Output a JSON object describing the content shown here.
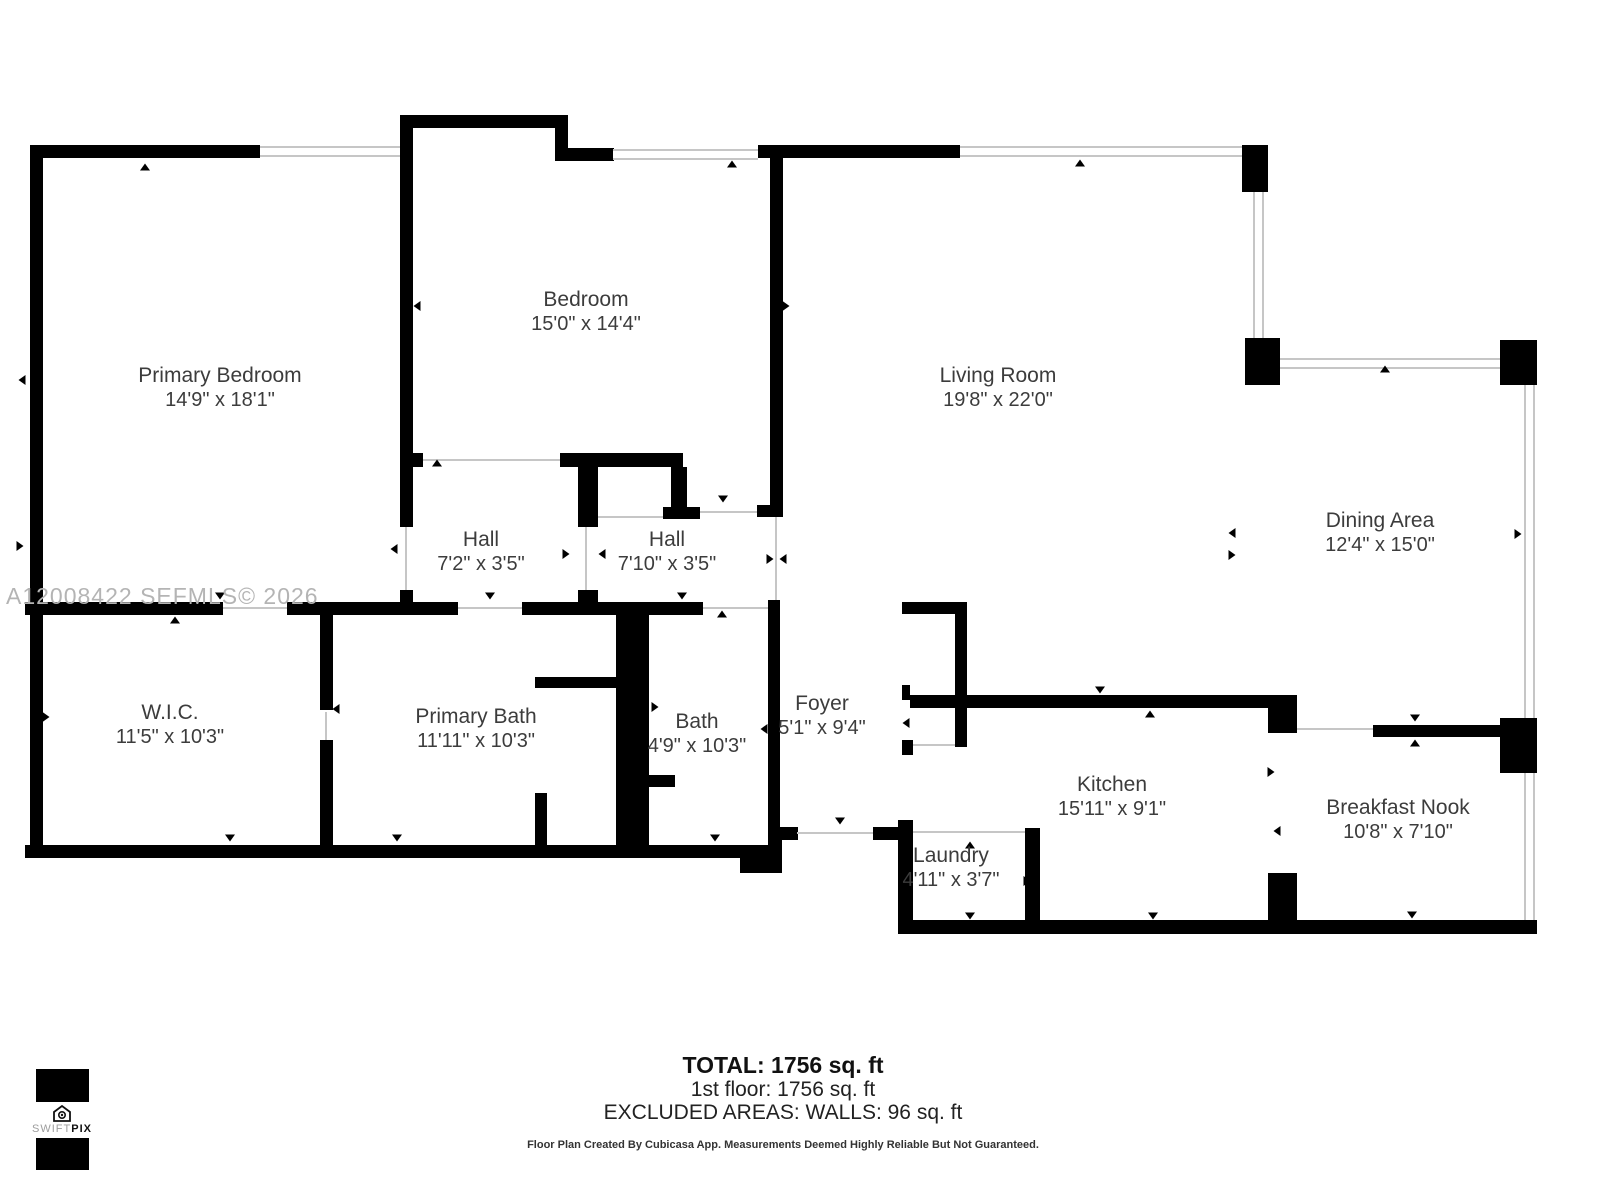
{
  "watermark": "A12008422  SEFMLS© 2026",
  "rooms": [
    {
      "name": "Primary Bedroom",
      "dims": "14'9\" x 18'1\"",
      "x": 220,
      "y": 388
    },
    {
      "name": "Bedroom",
      "dims": "15'0\" x 14'4\"",
      "x": 586,
      "y": 312
    },
    {
      "name": "Living Room",
      "dims": "19'8\" x 22'0\"",
      "x": 998,
      "y": 388
    },
    {
      "name": "Dining Area",
      "dims": "12'4\" x 15'0\"",
      "x": 1380,
      "y": 533
    },
    {
      "name": "Hall",
      "dims": "7'2\" x 3'5\"",
      "x": 481,
      "y": 552
    },
    {
      "name": "Hall",
      "dims": "7'10\" x 3'5\"",
      "x": 667,
      "y": 552
    },
    {
      "name": "W.I.C.",
      "dims": "11'5\" x 10'3\"",
      "x": 170,
      "y": 725
    },
    {
      "name": "Primary Bath",
      "dims": "11'11\" x 10'3\"",
      "x": 476,
      "y": 729
    },
    {
      "name": "Bath",
      "dims": "4'9\" x 10'3\"",
      "x": 697,
      "y": 734
    },
    {
      "name": "Foyer",
      "dims": "5'1\" x 9'4\"",
      "x": 822,
      "y": 716
    },
    {
      "name": "Kitchen",
      "dims": "15'11\" x 9'1\"",
      "x": 1112,
      "y": 797
    },
    {
      "name": "Laundry",
      "dims": "4'11\" x 3'7\"",
      "x": 951,
      "y": 868
    },
    {
      "name": "Breakfast Nook",
      "dims": "10'8\" x 7'10\"",
      "x": 1398,
      "y": 820
    }
  ],
  "footer": {
    "total": "TOTAL: 1756 sq. ft",
    "floor1": "1st floor: 1756 sq. ft",
    "excluded": "EXCLUDED AREAS: WALLS: 96 sq. ft",
    "disclaimer": "Floor Plan Created By Cubicasa App. Measurements Deemed Highly Reliable But Not Guaranteed."
  },
  "logo": {
    "brand_left": "SWIFT",
    "brand_right": "PIX",
    "icon": "house-camera-icon"
  },
  "colors": {
    "wall": "#000000",
    "window_line": "#c6c6c6",
    "text": "#3c3c3c",
    "watermark": "#b4b4b4"
  }
}
